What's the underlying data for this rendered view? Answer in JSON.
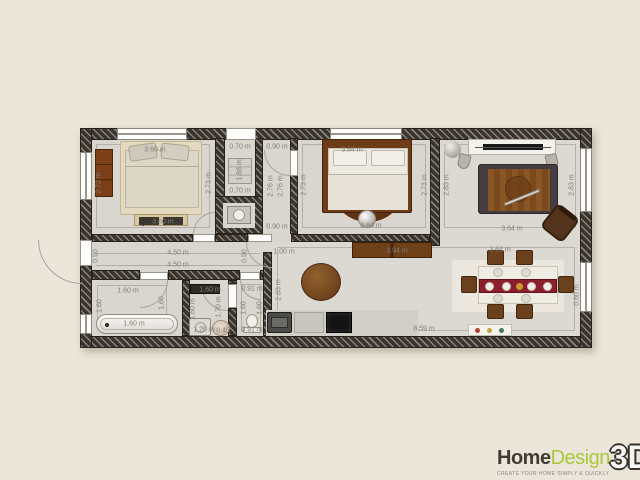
{
  "logo": {
    "home": "Home",
    "design": "Design",
    "three_d": "3D",
    "tagline": "CREATE YOUR HOME SIMPLY & QUICKLY"
  },
  "colors": {
    "wall": "#38342d",
    "floor": "#d9d6cf",
    "background": "#ece6da",
    "logo_green": "#a9c73e",
    "wood": "#7a4a1e",
    "runner_red": "#8b1f2e"
  },
  "plan": {
    "rooms": [
      "bedroom-1",
      "closet",
      "corridor",
      "bedroom-2",
      "tv-room",
      "hallway",
      "bathroom",
      "laundry",
      "wc",
      "living-dining-kitchen"
    ],
    "dim_labels": [
      {
        "t": "3.60 m",
        "x": 155,
        "y": 150,
        "r": 0
      },
      {
        "t": "2.73 m",
        "x": 99,
        "y": 183,
        "r": 1
      },
      {
        "t": "2.73 m",
        "x": 209,
        "y": 183,
        "r": 1
      },
      {
        "t": "3.60 m",
        "x": 163,
        "y": 222,
        "r": 0
      },
      {
        "t": "0.70 m",
        "x": 240,
        "y": 147,
        "r": 0
      },
      {
        "t": "1.88 m",
        "x": 240,
        "y": 170,
        "r": 1
      },
      {
        "t": "0.70 m",
        "x": 240,
        "y": 191,
        "r": 0
      },
      {
        "t": "0.90 m",
        "x": 277,
        "y": 147,
        "r": 0
      },
      {
        "t": "2.76 m",
        "x": 271,
        "y": 186,
        "r": 1
      },
      {
        "t": "2.76 m",
        "x": 281,
        "y": 186,
        "r": 1
      },
      {
        "t": "0.90 m",
        "x": 277,
        "y": 227,
        "r": 0
      },
      {
        "t": "3.64 m",
        "x": 352,
        "y": 150,
        "r": 0
      },
      {
        "t": "2.73 m",
        "x": 304,
        "y": 185,
        "r": 1
      },
      {
        "t": "2.73 m",
        "x": 425,
        "y": 185,
        "r": 1
      },
      {
        "t": "3.64 m",
        "x": 371,
        "y": 226,
        "r": 0
      },
      {
        "t": "2.83 m",
        "x": 447,
        "y": 185,
        "r": 1
      },
      {
        "t": "2.83 m",
        "x": 572,
        "y": 185,
        "r": 1
      },
      {
        "t": "3.64 m",
        "x": 512,
        "y": 229,
        "r": 0
      },
      {
        "t": "4.50 m",
        "x": 178,
        "y": 253,
        "r": 0
      },
      {
        "t": "4.50 m",
        "x": 178,
        "y": 265,
        "r": 0
      },
      {
        "t": "0.90",
        "x": 96,
        "y": 256,
        "r": 1
      },
      {
        "t": "0.90",
        "x": 245,
        "y": 256,
        "r": 1
      },
      {
        "t": "1.60 m",
        "x": 128,
        "y": 291,
        "r": 0
      },
      {
        "t": "1.60",
        "x": 100,
        "y": 306,
        "r": 1
      },
      {
        "t": "1.60",
        "x": 162,
        "y": 303,
        "r": 1
      },
      {
        "t": "1.60 m",
        "x": 134,
        "y": 324,
        "r": 0
      },
      {
        "t": "1.60 m",
        "x": 210,
        "y": 290,
        "r": 0
      },
      {
        "t": "1.60 m",
        "x": 193,
        "y": 309,
        "r": 1
      },
      {
        "t": "1.70 m",
        "x": 219,
        "y": 307,
        "r": 1
      },
      {
        "t": "1.20 m",
        "x": 204,
        "y": 330,
        "r": 0
      },
      {
        "t": "0.45",
        "x": 223,
        "y": 331,
        "r": 0
      },
      {
        "t": "0.91 m",
        "x": 252,
        "y": 289,
        "r": 0
      },
      {
        "t": "1.60",
        "x": 244,
        "y": 308,
        "r": 1
      },
      {
        "t": "1.60",
        "x": 260,
        "y": 308,
        "r": 1
      },
      {
        "t": "0.91 m",
        "x": 252,
        "y": 330,
        "r": 0
      },
      {
        "t": "1.00 m",
        "x": 284,
        "y": 252,
        "r": 0
      },
      {
        "t": "2.83 m",
        "x": 279,
        "y": 290,
        "r": 1
      },
      {
        "t": "3.94 m",
        "x": 397,
        "y": 251,
        "r": 0
      },
      {
        "t": "3.64 m",
        "x": 500,
        "y": 250,
        "r": 0
      },
      {
        "t": "8.59 m",
        "x": 424,
        "y": 329,
        "r": 0
      },
      {
        "t": "0.60 m",
        "x": 577,
        "y": 295,
        "r": 1
      }
    ]
  }
}
